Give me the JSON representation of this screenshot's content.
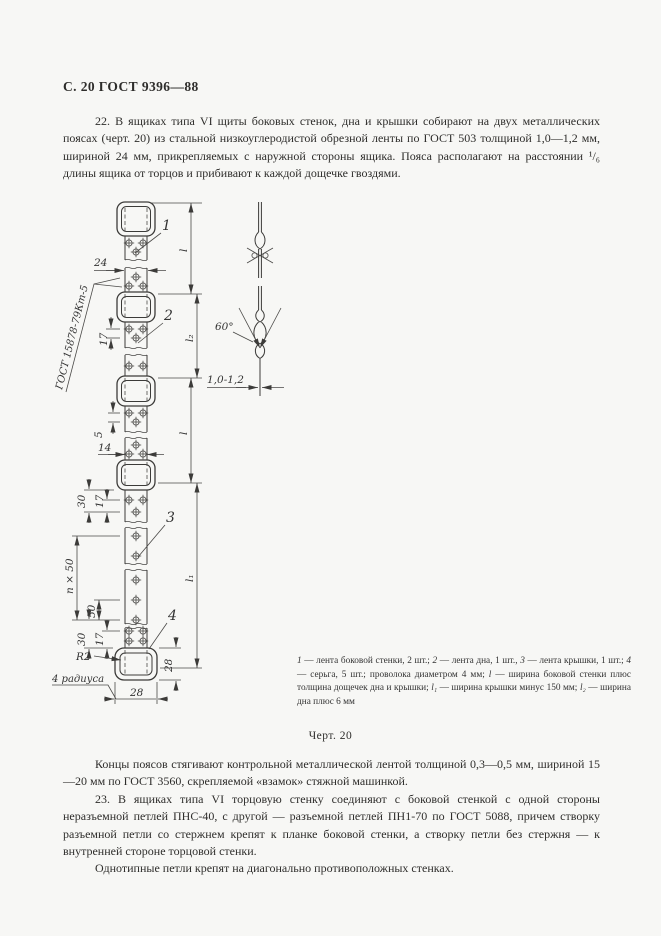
{
  "page": {
    "header": "С. 20 ГОСТ 9396—88",
    "para_22": "22. В ящиках типа VI щиты боковых стенок, дна и крышки собирают на двух металлических поясах (черт. 20) из стальной низкоуглеродистой обрезной ленты по ГОСТ 503 толщиной 1,0—1,2 мм, шириной 24 мм, прикрепляемых с наружной стороны ящика. Пояса располагают на расстоянии ¹/₆ длины ящика от торцов и прибивают к каждой дощечке гвоздями.",
    "caption": "Черт. 20",
    "para_ends": "Концы поясов стягивают контрольной металлической лентой толщиной 0,3—0,5 мм, шириной 15—20 мм по ГОСТ 3560, скрепляемой «взамок» стяжной машинкой.",
    "para_23": "23. В ящиках типа VI торцовую стенку соединяют с боковой стенкой с одной стороны неразъемной петлей ПНС-40, с другой — разъемной петлей ПН1-70 по ГОСТ 5088, причем створку разъемной петли со стержнем крепят к планке боковой стенки, а створку петли без стержня — к внутренней стороне торцовой стенки.",
    "para_hinges": "Однотипные петли крепят на диагонально противоположных стенках."
  },
  "figure": {
    "weld_note": "ГОСТ 15878-79Кт-5",
    "part_labels": {
      "p1": "1",
      "p2": "2",
      "p3": "3",
      "p4": "4"
    },
    "dims": {
      "band_width": "24",
      "pitch_17": "17",
      "gap_5": "5",
      "pair_span_14": "14",
      "edge_30": "30",
      "n_by_50": "n × 50",
      "step_50": "50",
      "buckle_h_28": "28",
      "buckle_w_28": "28",
      "radius": "R2",
      "radius_note": "4 радиуса",
      "len_l": "l",
      "len_l1": "l₁",
      "len_l2": "l₂",
      "angle_60": "60°",
      "thickness": "1,0-1,2"
    }
  },
  "legend": {
    "segments": [
      {
        "text": "1",
        "italic": true
      },
      {
        "text": " — лента боковой стенки, 2 шт.; ",
        "italic": false
      },
      {
        "text": "2",
        "italic": true
      },
      {
        "text": " — лента дна, 1 шт., ",
        "italic": false
      },
      {
        "text": "3",
        "italic": true
      },
      {
        "text": " — лента крышки, 1 шт.; ",
        "italic": false
      },
      {
        "text": "4",
        "italic": true
      },
      {
        "text": " — серьга, 5 шт.; проволока диаметром 4 мм; ",
        "italic": false
      },
      {
        "text": "l",
        "italic": true
      },
      {
        "text": " — ширина боковой стенки плюс толщина дощечек дна и крышки; ",
        "italic": false
      },
      {
        "text": "l₁",
        "italic": true
      },
      {
        "text": " — ширина крышки минус 150 мм; ",
        "italic": false
      },
      {
        "text": "l₂",
        "italic": true
      },
      {
        "text": " — ширина дна плюс 6 мм",
        "italic": false
      }
    ]
  },
  "colors": {
    "ink": "#3c3b39",
    "paper": "#f7f7f5"
  }
}
